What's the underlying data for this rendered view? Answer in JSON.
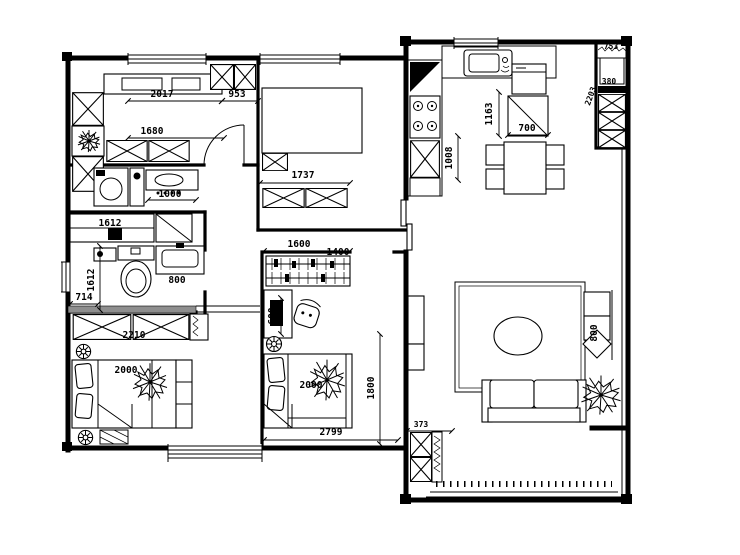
{
  "colors": {
    "line": "#000000",
    "background": "#ffffff",
    "threshold": "#8e8e8e"
  },
  "labels": {
    "bedroom1_width": "2017",
    "bedroom1_width_right": "953",
    "bedroom1_wardrobe": "1680",
    "study_bed_width": "1737",
    "vanity_width": "1000",
    "bath_cabinet": "1612",
    "bath_depth": "1612",
    "bath_offset": "714",
    "bath_sink": "800",
    "bedroom3_wardrobe": "2210",
    "bedroom3_bed": "2000",
    "bedroom2_wardrobe": "1600",
    "bedroom2_entry": "1400",
    "bedroom2_desk": "600",
    "bedroom2_bed": "2000",
    "bedroom2_depth": "1800",
    "bedroom2_width": "2799",
    "kitchen_counter": "1008",
    "kitchen_fridge_depth": "1163",
    "kitchen_cabinet": "700",
    "utility_top": "753",
    "utility_shelf": "380",
    "utility_height": "2203",
    "sofa_side": "800",
    "tv_wall": "373"
  }
}
